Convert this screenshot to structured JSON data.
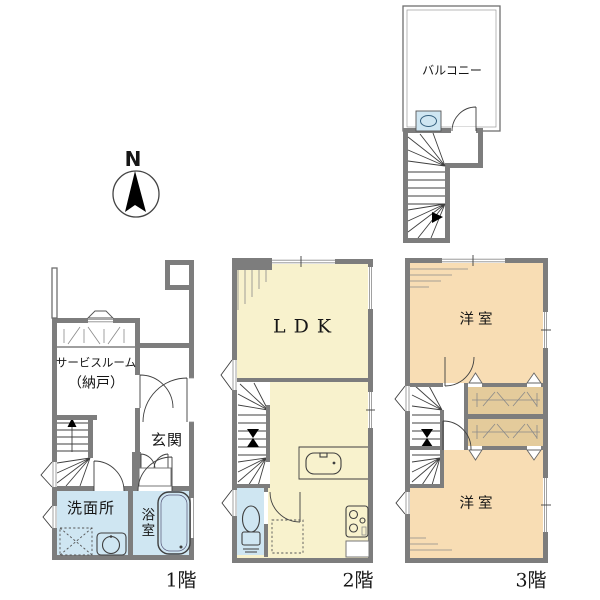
{
  "colors": {
    "wall": "#7d7d7d",
    "cream": "#f8f2cd",
    "peach": "#f8ddb4",
    "tan": "#e4cb9b",
    "blue": "#cfe6f2",
    "line": "#3f3f3f",
    "text": "#161616"
  },
  "compass": {
    "label": "N"
  },
  "roof": {
    "balcony_label": "バルコニー"
  },
  "floor1": {
    "label": "1階",
    "service_room_line1": "サービスルーム",
    "service_room_line2": "（納戸）",
    "entrance": "玄関",
    "washroom": "洗面所",
    "bathroom": "浴室"
  },
  "floor2": {
    "label": "2階",
    "ldk": "LDK"
  },
  "floor3": {
    "label": "3階",
    "room_top": "洋室",
    "room_bottom": "洋室"
  }
}
